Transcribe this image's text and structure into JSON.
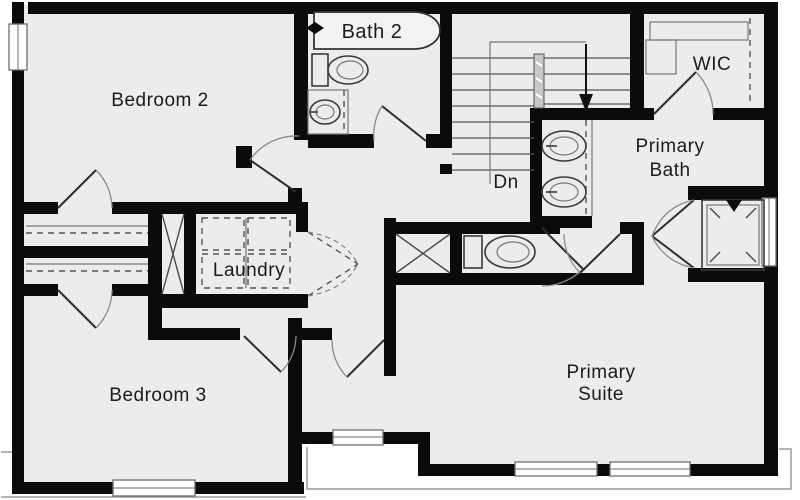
{
  "title": "Second floor plan",
  "colors": {
    "wall": "#0b0b0b",
    "floor": "#ECEBED",
    "background": "#ffffff",
    "fixture_line": "#3a3a3a",
    "thin_line": "#8a8a8a"
  },
  "rooms": {
    "bedroom2": {
      "label": "Bedroom 2"
    },
    "bath2": {
      "label": "Bath 2"
    },
    "wic": {
      "label": "WIC"
    },
    "stairs": {
      "label": "Dn"
    },
    "primary_bath": {
      "line1": "Primary",
      "line2": "Bath"
    },
    "laundry": {
      "label": "Laundry"
    },
    "bedroom3": {
      "label": "Bedroom 3"
    },
    "primary_suite": {
      "line1": "Primary",
      "line2": "Suite"
    }
  }
}
